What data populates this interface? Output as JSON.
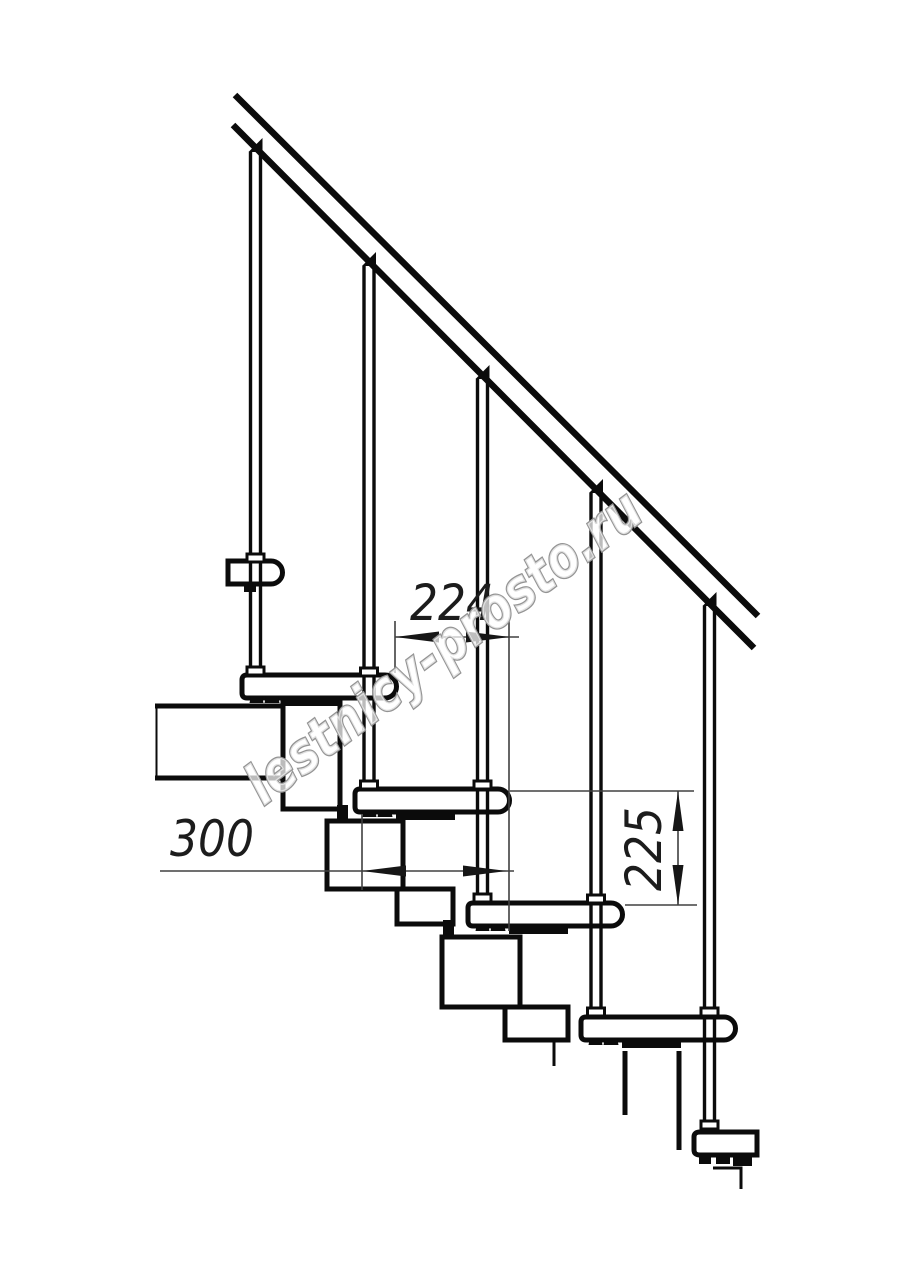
{
  "page": {
    "title": "Modular staircase side-view technical drawing",
    "background": "#ffffff"
  },
  "watermark": {
    "text": "lestnicy-prosto.ru",
    "color": "#949494"
  },
  "dimensions": {
    "tread_overlap": {
      "value": "224",
      "orientation": "horizontal",
      "units": "mm"
    },
    "step_length": {
      "value": "300",
      "orientation": "horizontal",
      "units": "mm"
    },
    "step_height": {
      "value": "225",
      "orientation": "vertical",
      "units": "mm"
    }
  },
  "drawing": {
    "line_color": "#0b0b0b",
    "dim_line_color": "#404040",
    "balusters_count": 5,
    "treads_count": 6,
    "handrail": "diagonal-double-line"
  }
}
